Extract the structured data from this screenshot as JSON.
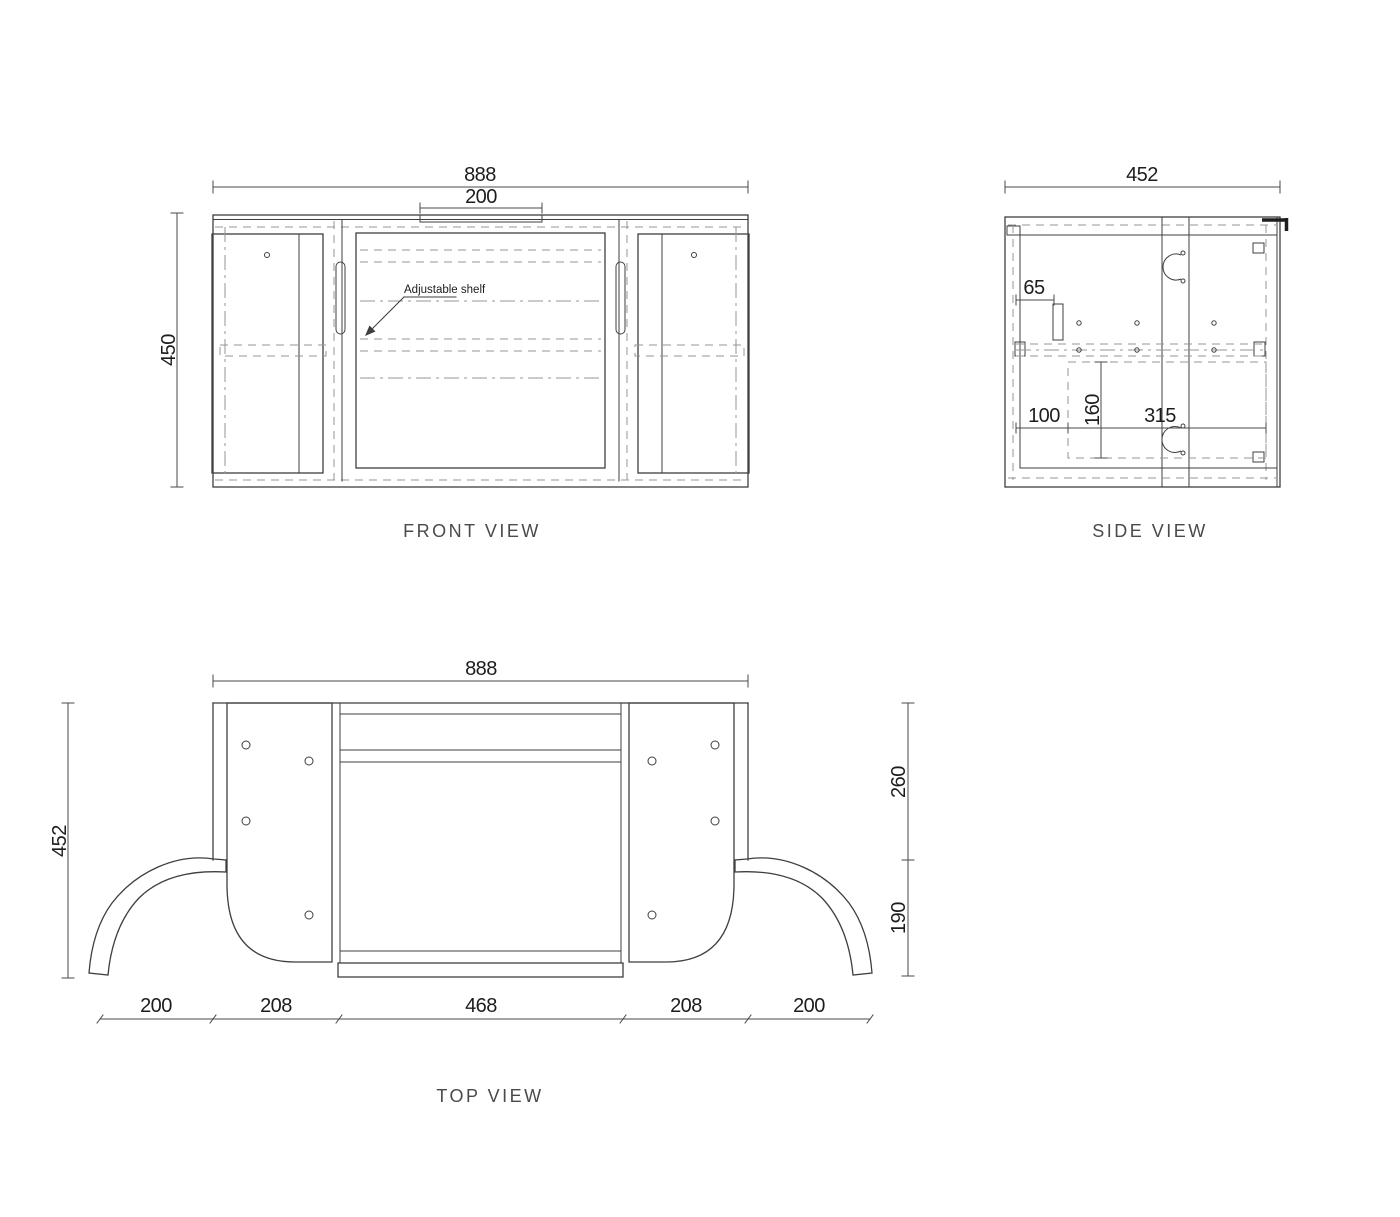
{
  "colors": {
    "background": "#ffffff",
    "line": "#3f3f3f",
    "dashed": "#969696",
    "dimension": "#4a4a4a",
    "text": "#1d1d1d",
    "view_label": "#4a4a4a"
  },
  "drawing": {
    "front": {
      "label": "FRONT VIEW",
      "annotation": "Adjustable shelf",
      "dims": {
        "overall_width": "888",
        "recess_width": "200",
        "height": "450"
      }
    },
    "side": {
      "label": "SIDE VIEW",
      "dims": {
        "depth": "452",
        "d65": "65",
        "d100": "100",
        "d160": "160",
        "d315": "315"
      }
    },
    "top": {
      "label": "TOP VIEW",
      "dims": {
        "overall_width": "888",
        "depth": "452",
        "d260": "260",
        "d190": "190",
        "bottom_segments": [
          "200",
          "208",
          "468",
          "208",
          "200"
        ]
      }
    }
  }
}
